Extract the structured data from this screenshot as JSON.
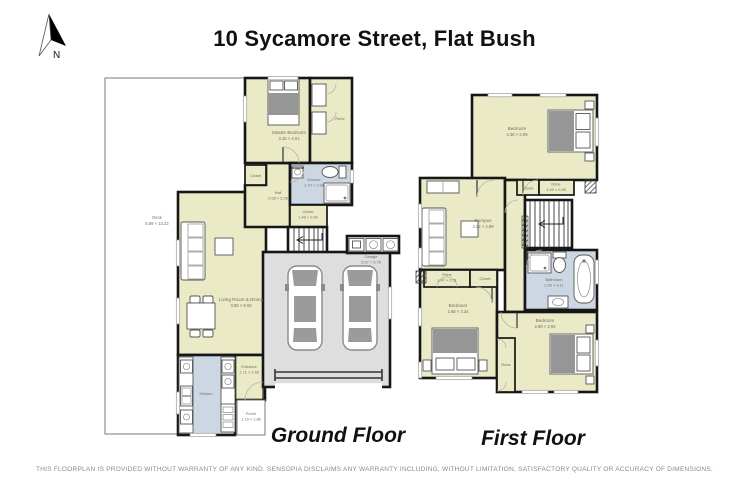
{
  "title": "10 Sycamore Street, Flat Bush",
  "compass": {
    "icon": "north-arrow-icon",
    "label": "N"
  },
  "disclaimer": "THIS FLOORPLAN IS PROVIDED WITHOUT WARRANTY OF ANY KIND. SENSOPIA DISCLAIMS ANY WARRANTY INCLUDING, WITHOUT LIMITATION, SATISFACTORY QUALITY OR ACCURACY OF DIMENSIONS.",
  "ground": {
    "caption": "Ground Floor",
    "rooms": {
      "deck": {
        "name": "Deck",
        "dims": "5.09 × 13.22"
      },
      "master": {
        "name": "Master Bedroom",
        "dims": "3.16 × 4.01"
      },
      "robe": {
        "name": "Robe"
      },
      "ensuite": {
        "name": "Ensuite",
        "dims": "1.70 × 1.98"
      },
      "closet_hall": {
        "name": "Closet"
      },
      "hall": {
        "name": "Hall",
        "dims": "2.08 × 2.28"
      },
      "closet": {
        "name": "Closet",
        "dims": "1.46 × 0.99"
      },
      "living": {
        "name": "Living Room & Dining",
        "dims": "3.88 × 8.08"
      },
      "kitchen": {
        "name": "Kitchen"
      },
      "entrance": {
        "name": "Entrance",
        "dims": "1.71 × 1.68"
      },
      "porch": {
        "name": "Porch",
        "dims": "1.15 × 1.86"
      },
      "garage": {
        "name": "Garage",
        "dims": "5.57 × 5.78"
      }
    }
  },
  "first": {
    "caption": "First Floor",
    "rooms": {
      "bedroom_top": {
        "name": "Bedroom",
        "dims": "4.36 × 2.99"
      },
      "closet_top": {
        "name": "Closet"
      },
      "robe_top": {
        "name": "Robe",
        "dims": "1.65 × 0.95"
      },
      "rumpus": {
        "name": "Rumpus",
        "dims": "4.22 × 4.89"
      },
      "bathroom": {
        "name": "Bathroom",
        "dims": "2.69 × 3.11"
      },
      "bedroom_left": {
        "name": "Bedroom",
        "dims": "2.88 × 3.34"
      },
      "robe_left": {
        "name": "Robe",
        "dims": "1.47 × 0.51"
      },
      "closet_left": {
        "name": "Closet"
      },
      "robe_mid": {
        "name": "Robe"
      },
      "bedroom_right": {
        "name": "Bedroom",
        "dims": "2.69 × 2.92"
      }
    }
  },
  "colors": {
    "room_fill": "#eaeac6",
    "wet_room_fill": "#cdd7e3",
    "garage_fill": "#dedede",
    "wall": "#161616",
    "deck_outline": "#777777",
    "label_text": "#70705c",
    "caption_text": "#111111"
  }
}
